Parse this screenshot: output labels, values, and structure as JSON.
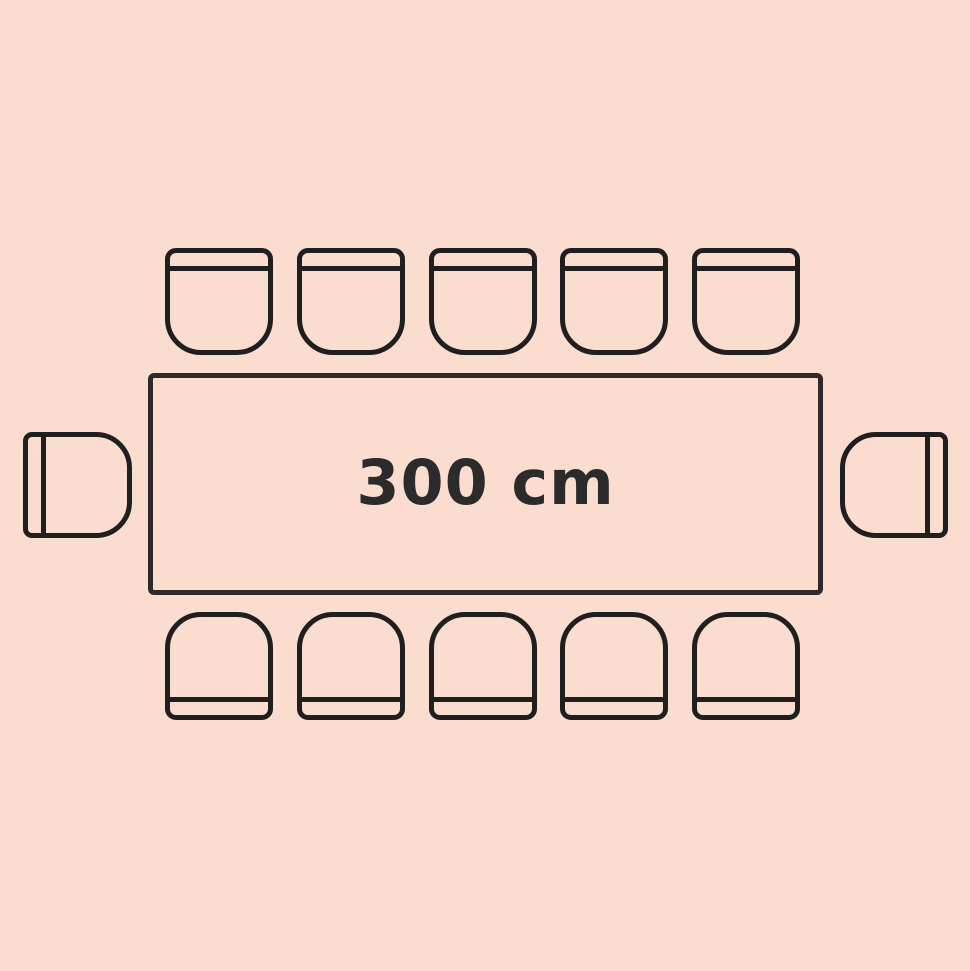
{
  "table": {
    "label": "300 cm"
  },
  "seats": {
    "top": 5,
    "bottom": 5,
    "left": 1,
    "right": 1,
    "total": 12
  },
  "colors": {
    "background": "#fbddd0",
    "chair_stroke": "#1f1f1f",
    "table_stroke": "#2e2a29",
    "label_text": "#2b2b2b"
  }
}
